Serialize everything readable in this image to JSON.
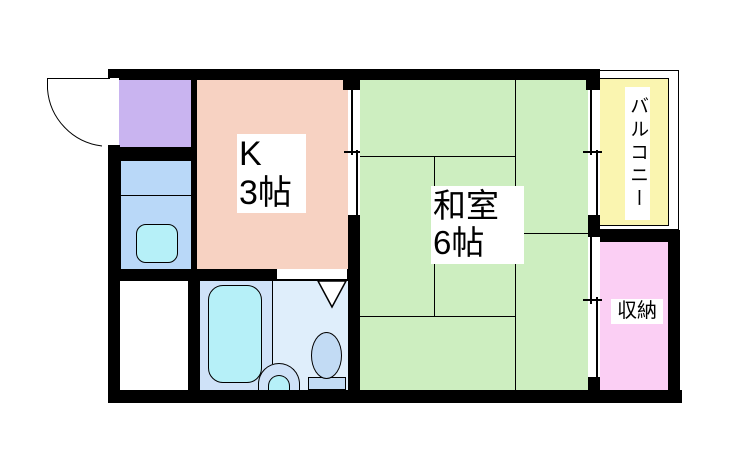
{
  "floor_plan": {
    "background_color": "#ffffff",
    "wall_color": "#000000",
    "rooms": {
      "entrance": {
        "color": "#c9b4f0"
      },
      "kitchen": {
        "label": "K",
        "size": "3帖",
        "color": "#f7d2c2"
      },
      "kitchen_counter": {
        "color": "#b9d8f8",
        "sink_color": "#b6f0f8"
      },
      "japanese_room": {
        "label": "和室",
        "size": "6帖",
        "color": "#cdeec0"
      },
      "balcony": {
        "label": "バルコニー",
        "color": "#faf5b0"
      },
      "storage": {
        "label": "収納",
        "color": "#fbcff4"
      },
      "utility_room": {
        "color": "#ffffff"
      },
      "bathroom": {
        "bath_area_color": "#cfe2f8",
        "toilet_area_color": "#dfeefb",
        "bathtub_color": "#b6f0f8",
        "basin_color": "#b6f0f8",
        "toilet_color": "#c2dbf4"
      }
    }
  }
}
